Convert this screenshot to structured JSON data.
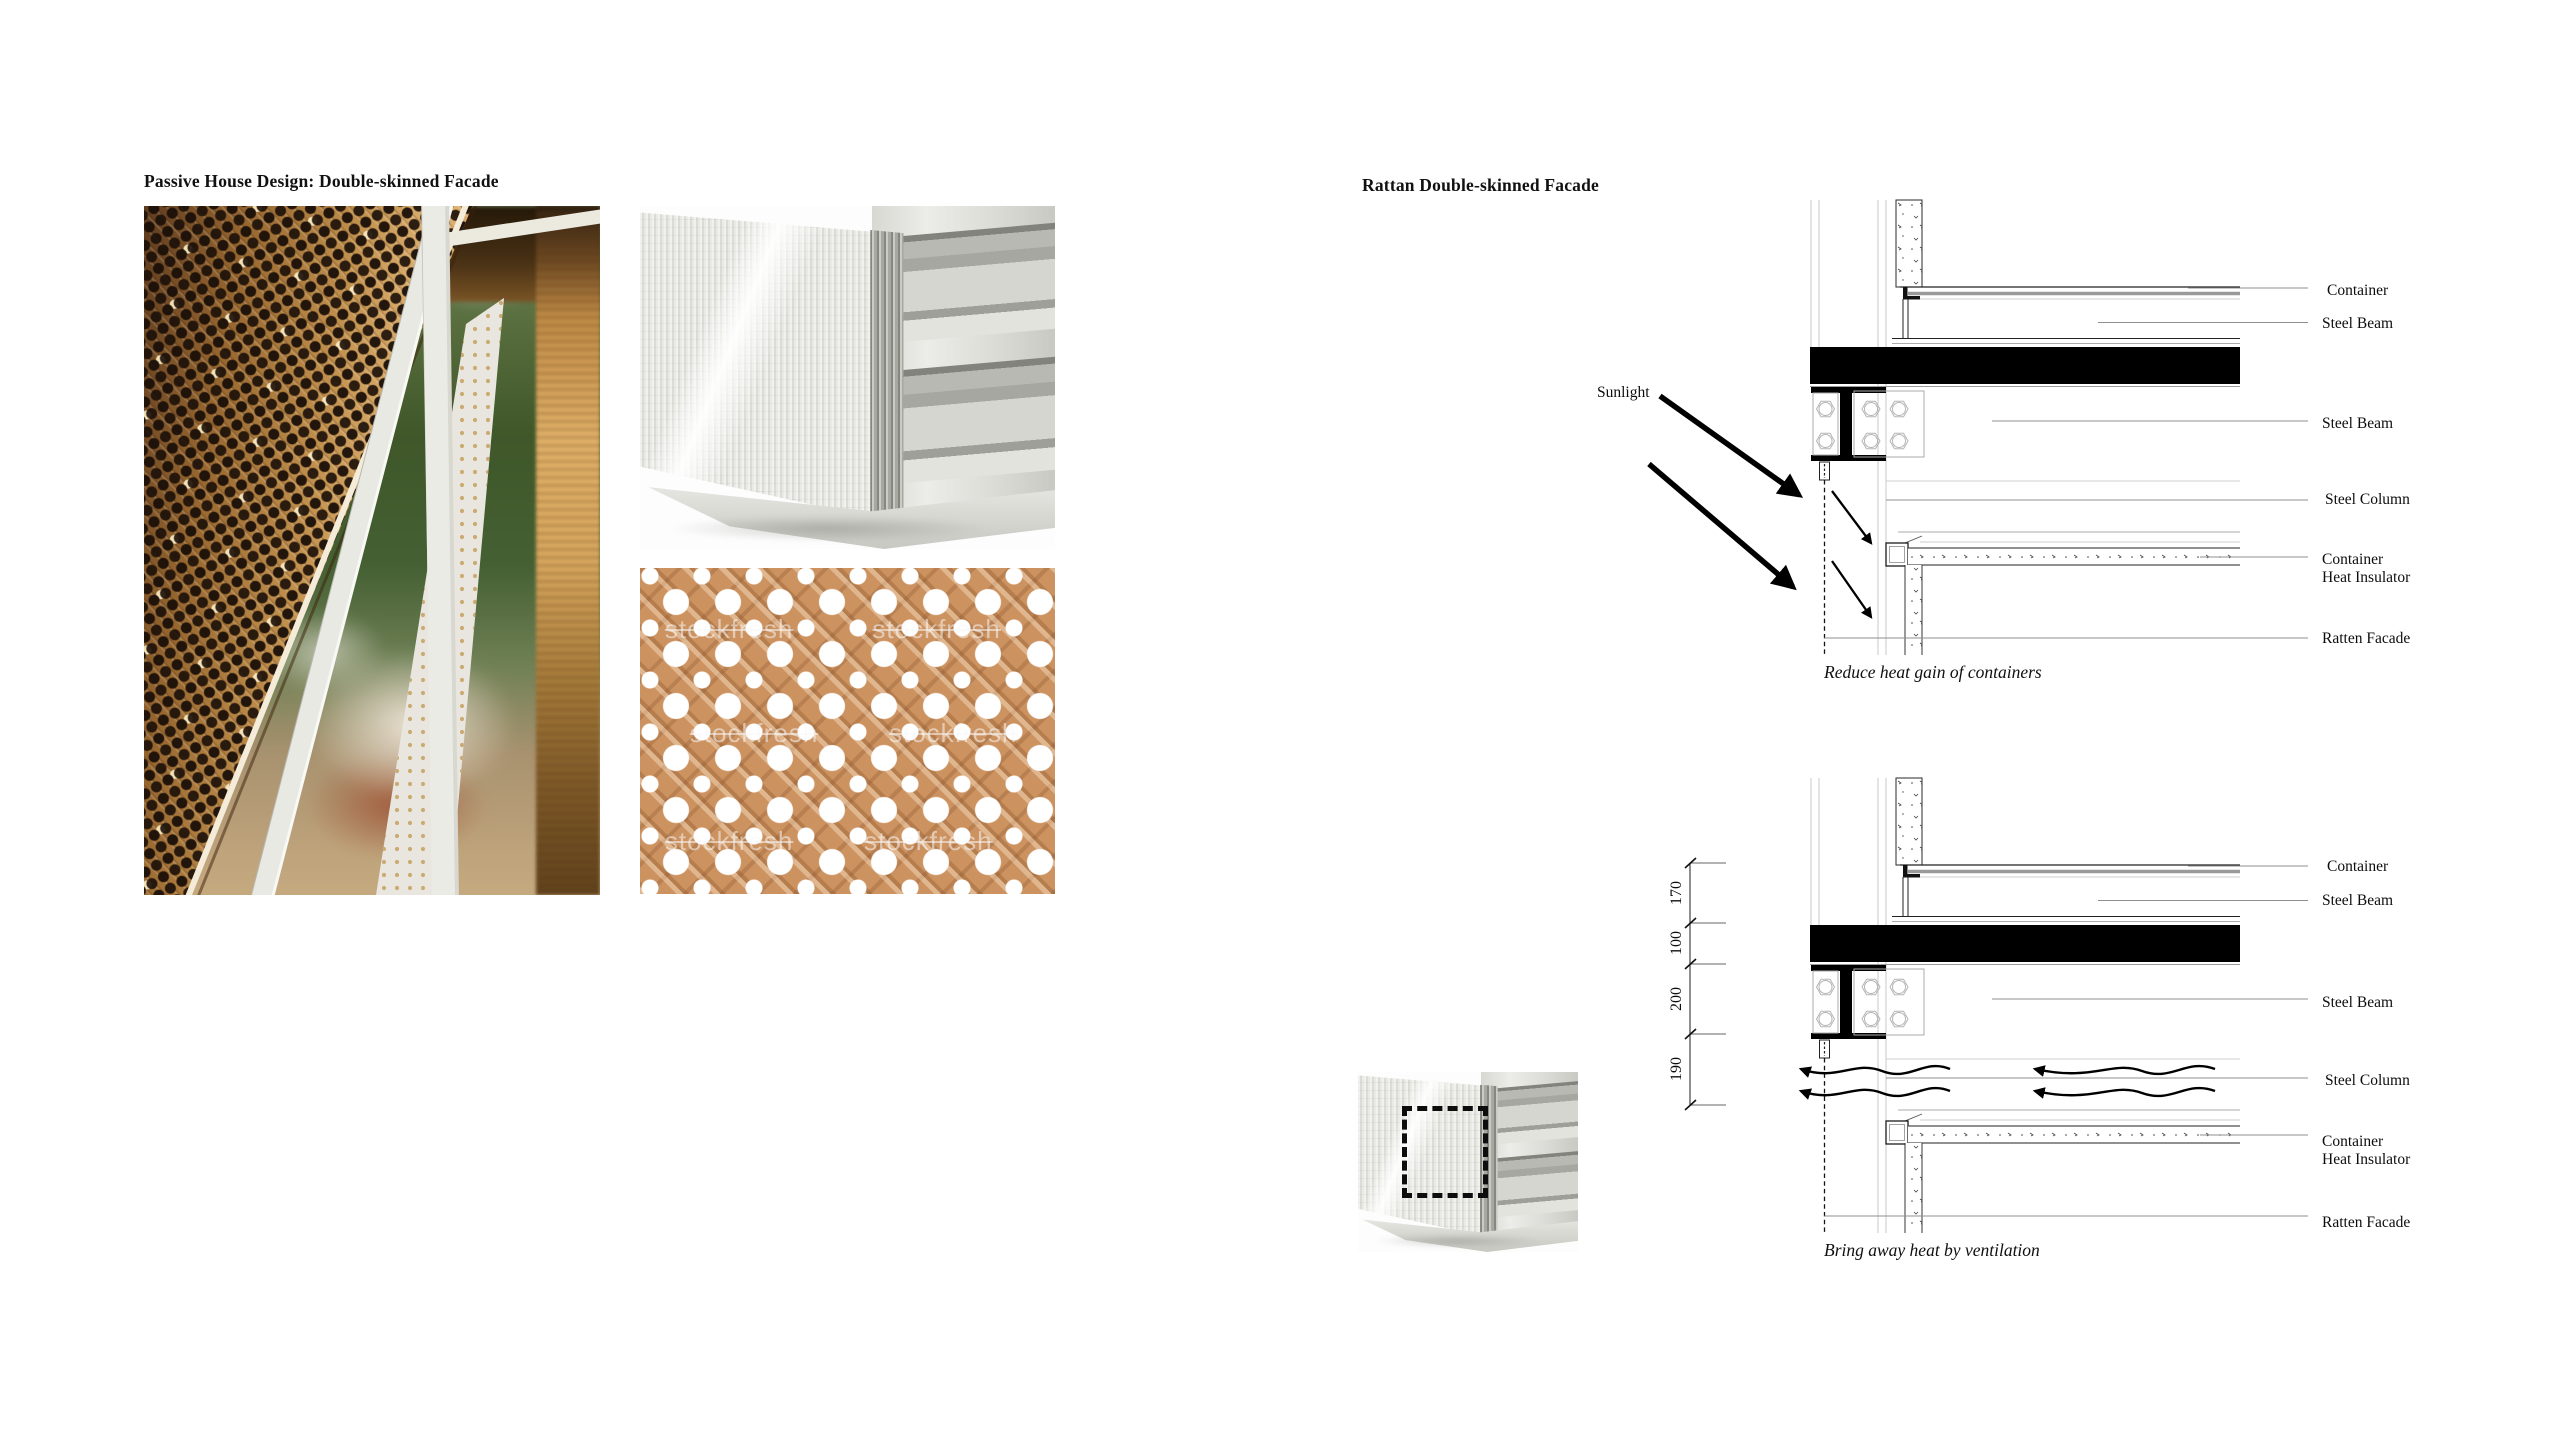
{
  "page": {
    "background": "#ffffff",
    "accent": "#000000"
  },
  "left_section": {
    "title": "Passive House Design: Double-skinned Facade",
    "images": {
      "facade_photo": {
        "name": "rattan-facade-closeup-photo"
      },
      "corner_render": {
        "name": "double-skin-corner-render"
      },
      "rattan_texture": {
        "name": "rattan-cane-webbing-texture",
        "watermark": "stockfresh"
      }
    }
  },
  "right_section": {
    "title": "Rattan Double-skinned Facade",
    "details": [
      {
        "annotation": "Sunlight",
        "caption": "Reduce heat gain of containers",
        "labels": [
          "Container",
          "Steel Beam",
          "Steel Beam",
          "Steel Column",
          "Container",
          "Heat Insulator",
          "Ratten Facade"
        ]
      },
      {
        "caption": "Bring away heat by ventilation",
        "labels": [
          "Container",
          "Steel Beam",
          "Steel Beam",
          "Steel Column",
          "Container",
          "Heat Insulator",
          "Ratten Facade"
        ],
        "dimensions_mm": [
          "170",
          "100",
          "200",
          "190"
        ]
      }
    ]
  }
}
